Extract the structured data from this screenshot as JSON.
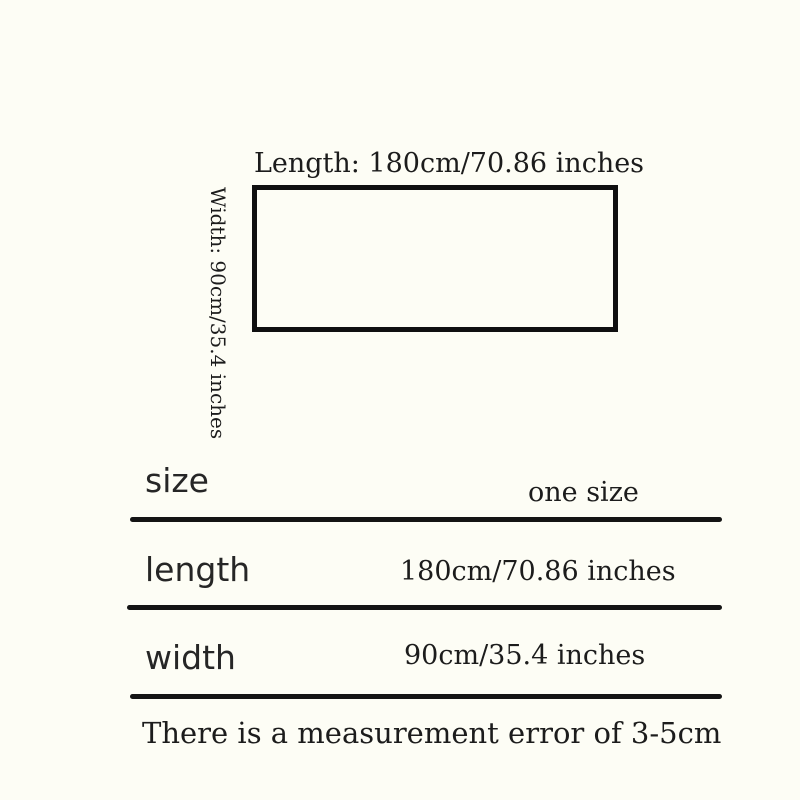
{
  "colors": {
    "background": "#fdfdf5",
    "ink": "#1c1c1c",
    "divider": "#141414"
  },
  "diagram": {
    "length_label": "Length: 180cm/70.86 inches",
    "width_label": "Width: 90cm/35.4 inches"
  },
  "size_table": {
    "rows": [
      {
        "label": "size",
        "value": "one size"
      },
      {
        "label": "length",
        "value": "180cm/70.86 inches"
      },
      {
        "label": "width",
        "value": "90cm/35.4 inches"
      }
    ],
    "note": "There is a measurement error of 3-5cm"
  }
}
